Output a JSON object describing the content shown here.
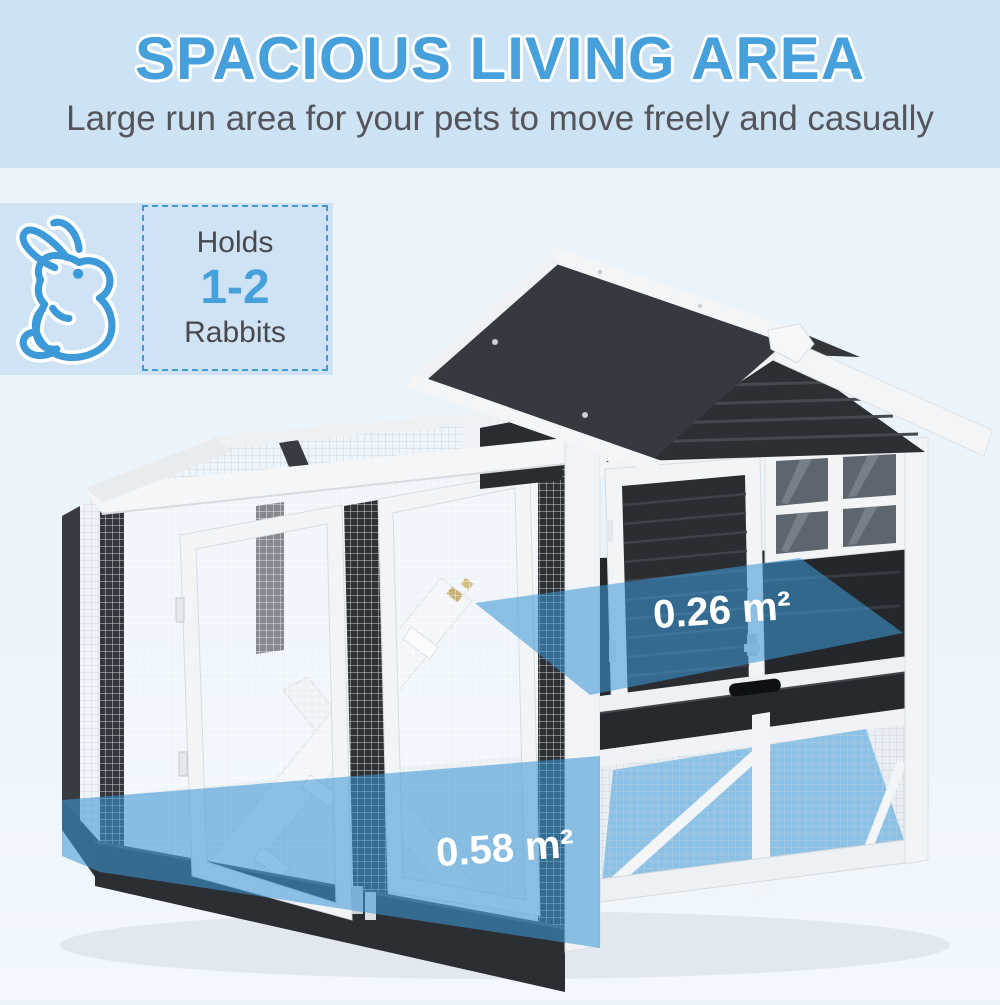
{
  "header": {
    "title": "SPACIOUS LIVING AREA",
    "subtitle": "Large run area for your pets to move freely and casually"
  },
  "capacity_badge": {
    "icon": "rabbit-icon",
    "prefix": "Holds",
    "count": "1-2",
    "animal": "Rabbits"
  },
  "product": {
    "name": "two-story rabbit hutch with run",
    "area_labels": [
      {
        "id": "upper-hutch-floor",
        "text": "0.26 m²"
      },
      {
        "id": "lower-run-floor",
        "text": "0.58 m²"
      }
    ]
  },
  "colors": {
    "accent_blue": "#46a0dc",
    "overlay_blue": "#3e97d4",
    "header_band": "#cde2f3",
    "badge_panel": "#cfe3f4",
    "badge_border": "#3f9ad6",
    "dark_wood": "#33363c",
    "white_wood": "#f2f4f6",
    "text_gray": "#54555a"
  }
}
